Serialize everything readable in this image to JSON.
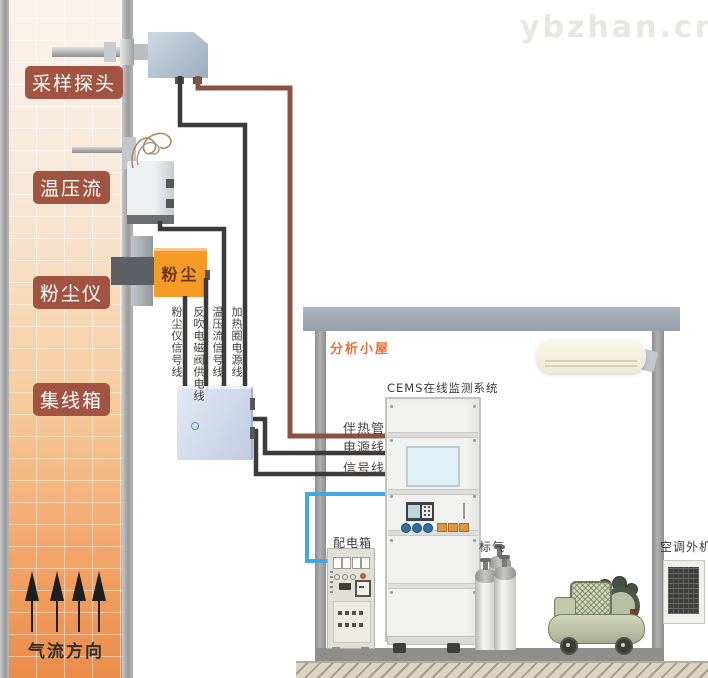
{
  "watermark": "ybzhan.cn",
  "chimney": {
    "labels": {
      "sampling_probe": "采样探头",
      "temp_pressure_flow": "温压流",
      "dust_meter": "粉尘仪",
      "junction_box": "集线箱"
    },
    "airflow_direction": "气流方向"
  },
  "devices": {
    "dust_box_text": "粉尘"
  },
  "wires": {
    "dust_signal": "粉尘仪信号线",
    "blowback_power": "反吹电磁阀供电线",
    "tpf_signal": "温压流信号线",
    "heating_coil_power": "加热圈电源线",
    "heat_traced": "伴热管",
    "power": "电源线",
    "signal": "信号线"
  },
  "shack": {
    "title": "分析小屋",
    "cems_title": "CEMS在线监测系统",
    "power_box": "配电箱",
    "standard_gas": "标气",
    "ac_outdoor": "空调外机"
  },
  "colors": {
    "wire_black": "#3B3B3B",
    "wire_brown": "#8A5243",
    "pipe_blue": "#41A8E1",
    "arrow_black": "#1F1F1F",
    "stack_label_bg": "#A25443",
    "dust_box_orange": "#F59B26",
    "shack_title_orange": "#E8713B",
    "roof_gray": "#9FA8B3",
    "watermark_gray": "#E9E7E4"
  }
}
